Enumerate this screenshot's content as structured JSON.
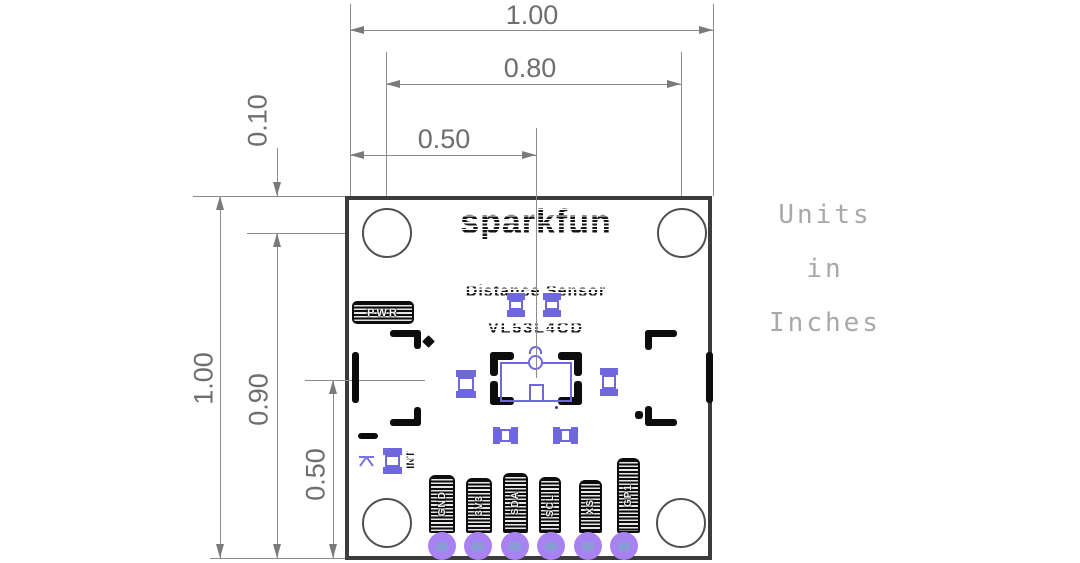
{
  "units_note": {
    "lines": [
      "Units",
      "in",
      "Inches"
    ]
  },
  "dimensions": {
    "top_width_full": "1.00",
    "top_width_holes": "0.80",
    "top_width_center": "0.50",
    "left_hole_offset": "0.10",
    "left_height_full": "1.00",
    "left_height_holes": "0.90",
    "left_height_center": "0.50"
  },
  "board": {
    "brand": "sparkfun",
    "product": "Distance Sensor",
    "part_number": "VL53L4CD",
    "power_led_label": "PWR",
    "jumper_label": "INT",
    "pin_labels": [
      "GND",
      "3V3",
      "SDA",
      "SCL",
      "XS",
      "GP1"
    ]
  },
  "colors": {
    "dimension_gray": "#6e6e6e",
    "silkscreen_black": "#0c0c0c",
    "smd_pad_blue": "#6f68dd",
    "th_pad_purple": "#a982f2",
    "th_hole_blue": "#8a9cd6",
    "note_gray": "#a9a9a9",
    "board_outline": "#3c3c3c"
  }
}
